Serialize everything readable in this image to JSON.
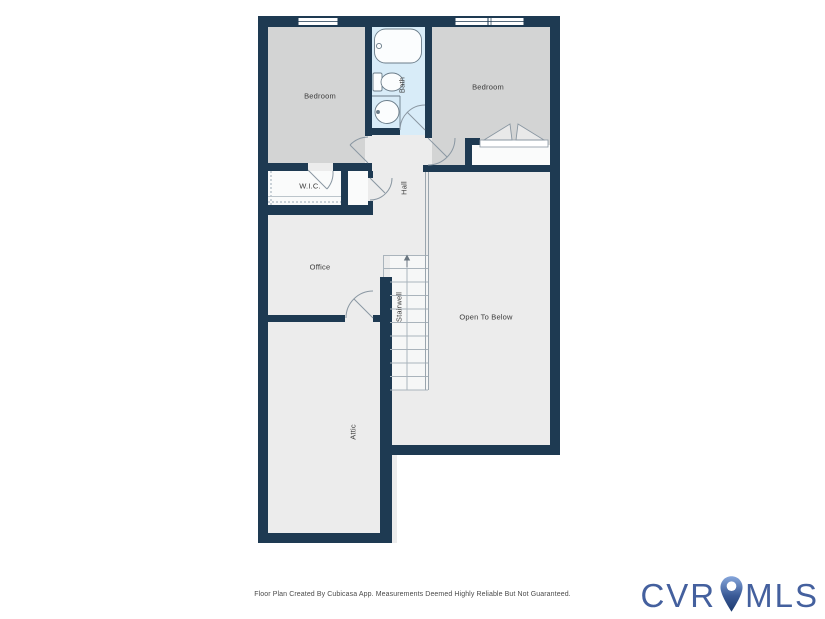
{
  "rooms": {
    "bedroom_left": {
      "label": "Bedroom"
    },
    "bath": {
      "label": "Bath"
    },
    "bedroom_right": {
      "label": "Bedroom"
    },
    "wic": {
      "label": "W.I.C."
    },
    "hall": {
      "label": "Hall"
    },
    "office": {
      "label": "Office"
    },
    "stairwell": {
      "label": "Stairwell"
    },
    "open_to_below": {
      "label": "Open To Below"
    },
    "attic": {
      "label": "Attic"
    }
  },
  "footer": {
    "disclaimer": "Floor Plan Created By Cubicasa App. Measurements Deemed Highly Reliable But Not Guaranteed."
  },
  "logo": {
    "prefix": "CVR",
    "suffix": "MLS",
    "pin_icon": "map-pin-icon"
  },
  "colors": {
    "wall": "#1e3a52",
    "bedroom_fill": "#d3d4d4",
    "bath_fill": "#d8ecf8",
    "floor_fill": "#ececec",
    "closet_fill": "#fafbfb",
    "door_arc": "#8a97a2",
    "label_text": "#3a3a3a",
    "logo_blue": "#44609e",
    "pin_gradient_top": "#86a6db",
    "pin_gradient_bottom": "#1c3a6e"
  }
}
